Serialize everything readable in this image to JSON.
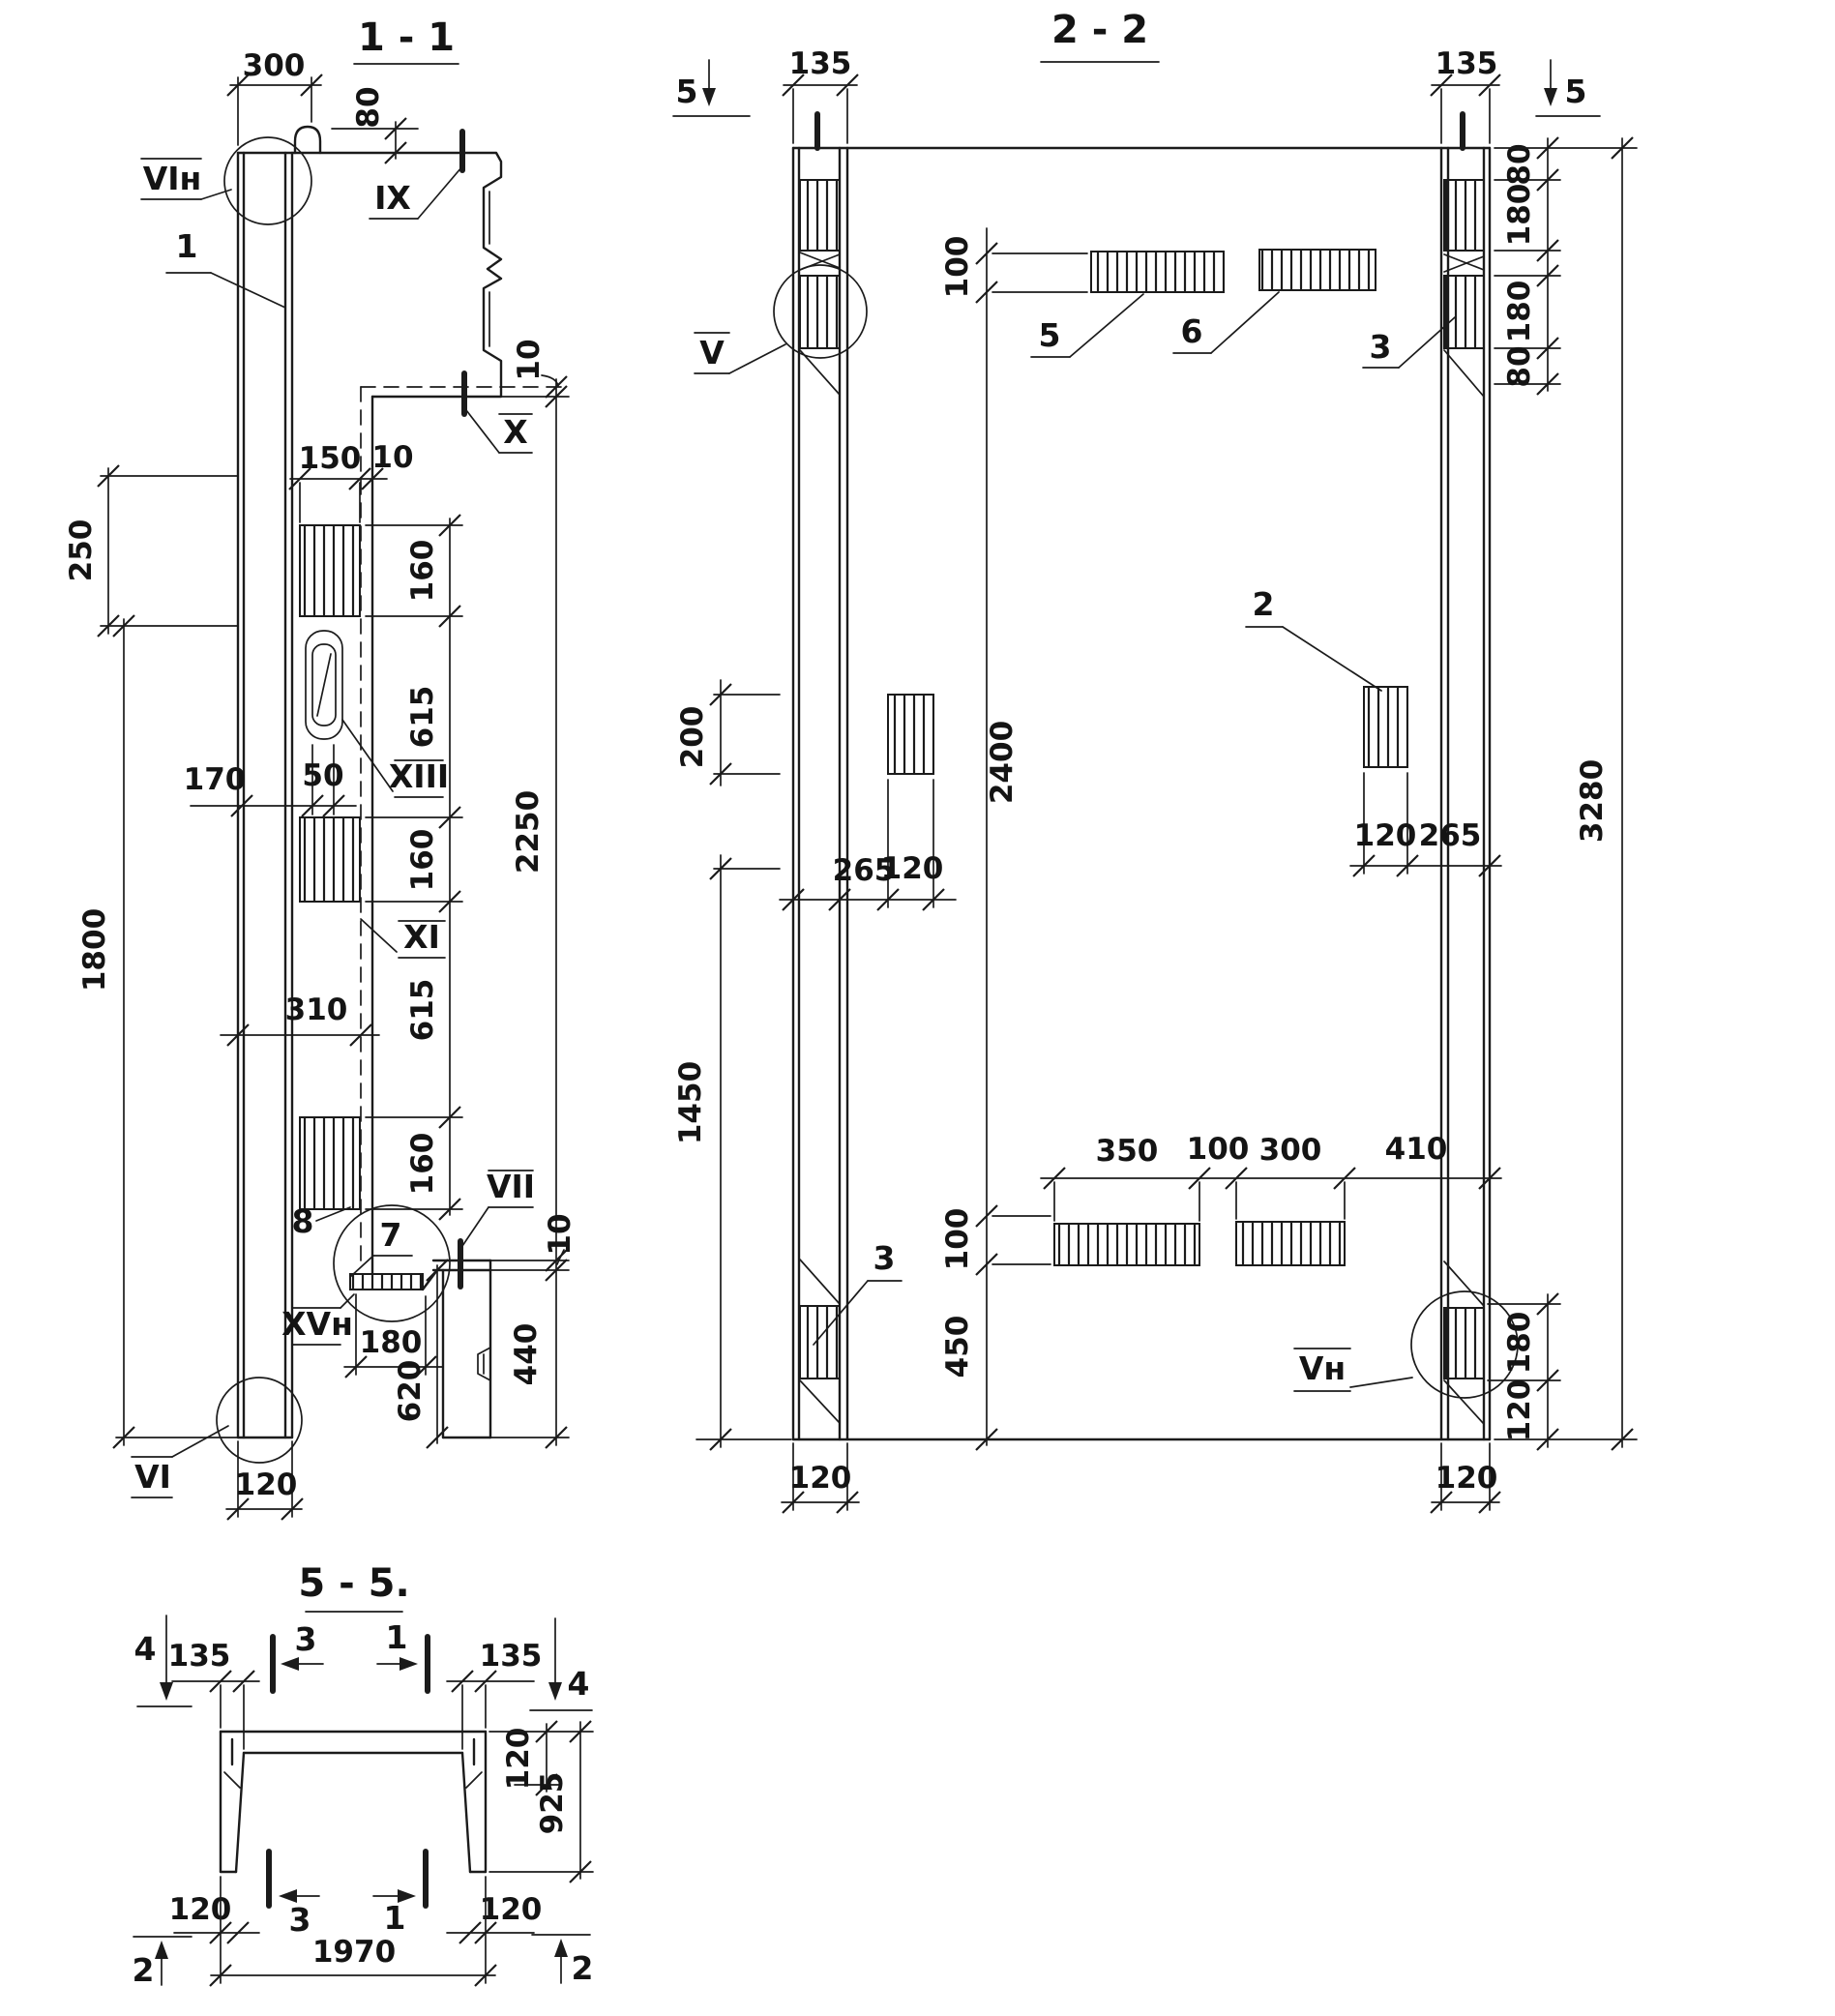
{
  "colors": {
    "ink": "#1b1b1b",
    "paper": "#ffffff"
  },
  "titles": {
    "s11": "1 - 1",
    "s22": "2 - 2",
    "s55": "5 - 5."
  },
  "dims": {
    "d10": "10",
    "d50": "50",
    "d80": "80",
    "d100": "100",
    "d120": "120",
    "d135": "135",
    "d150": "150",
    "d160": "160",
    "d170": "170",
    "d180": "180",
    "d200": "200",
    "d250": "250",
    "d265": "265",
    "d300": "300",
    "d310": "310",
    "d350": "350",
    "d410": "410",
    "d440": "440",
    "d450": "450",
    "d615": "615",
    "d620": "620",
    "d925": "925",
    "d1450": "1450",
    "d1800": "1800",
    "d1970": "1970",
    "d2250": "2250",
    "d2400": "2400",
    "d3280": "3280"
  },
  "markers": {
    "vi_n": "VIн",
    "ix": "IX",
    "x": "X",
    "xiii": "XIII",
    "xi": "XI",
    "vii": "VII",
    "xv_n": "XVн",
    "vi": "VI",
    "v": "V",
    "v_n": "Vн"
  },
  "labels": {
    "n1": "1",
    "n2": "2",
    "n3": "3",
    "n4": "4",
    "n5": "5",
    "n6": "6",
    "n7": "7",
    "n8": "8"
  }
}
